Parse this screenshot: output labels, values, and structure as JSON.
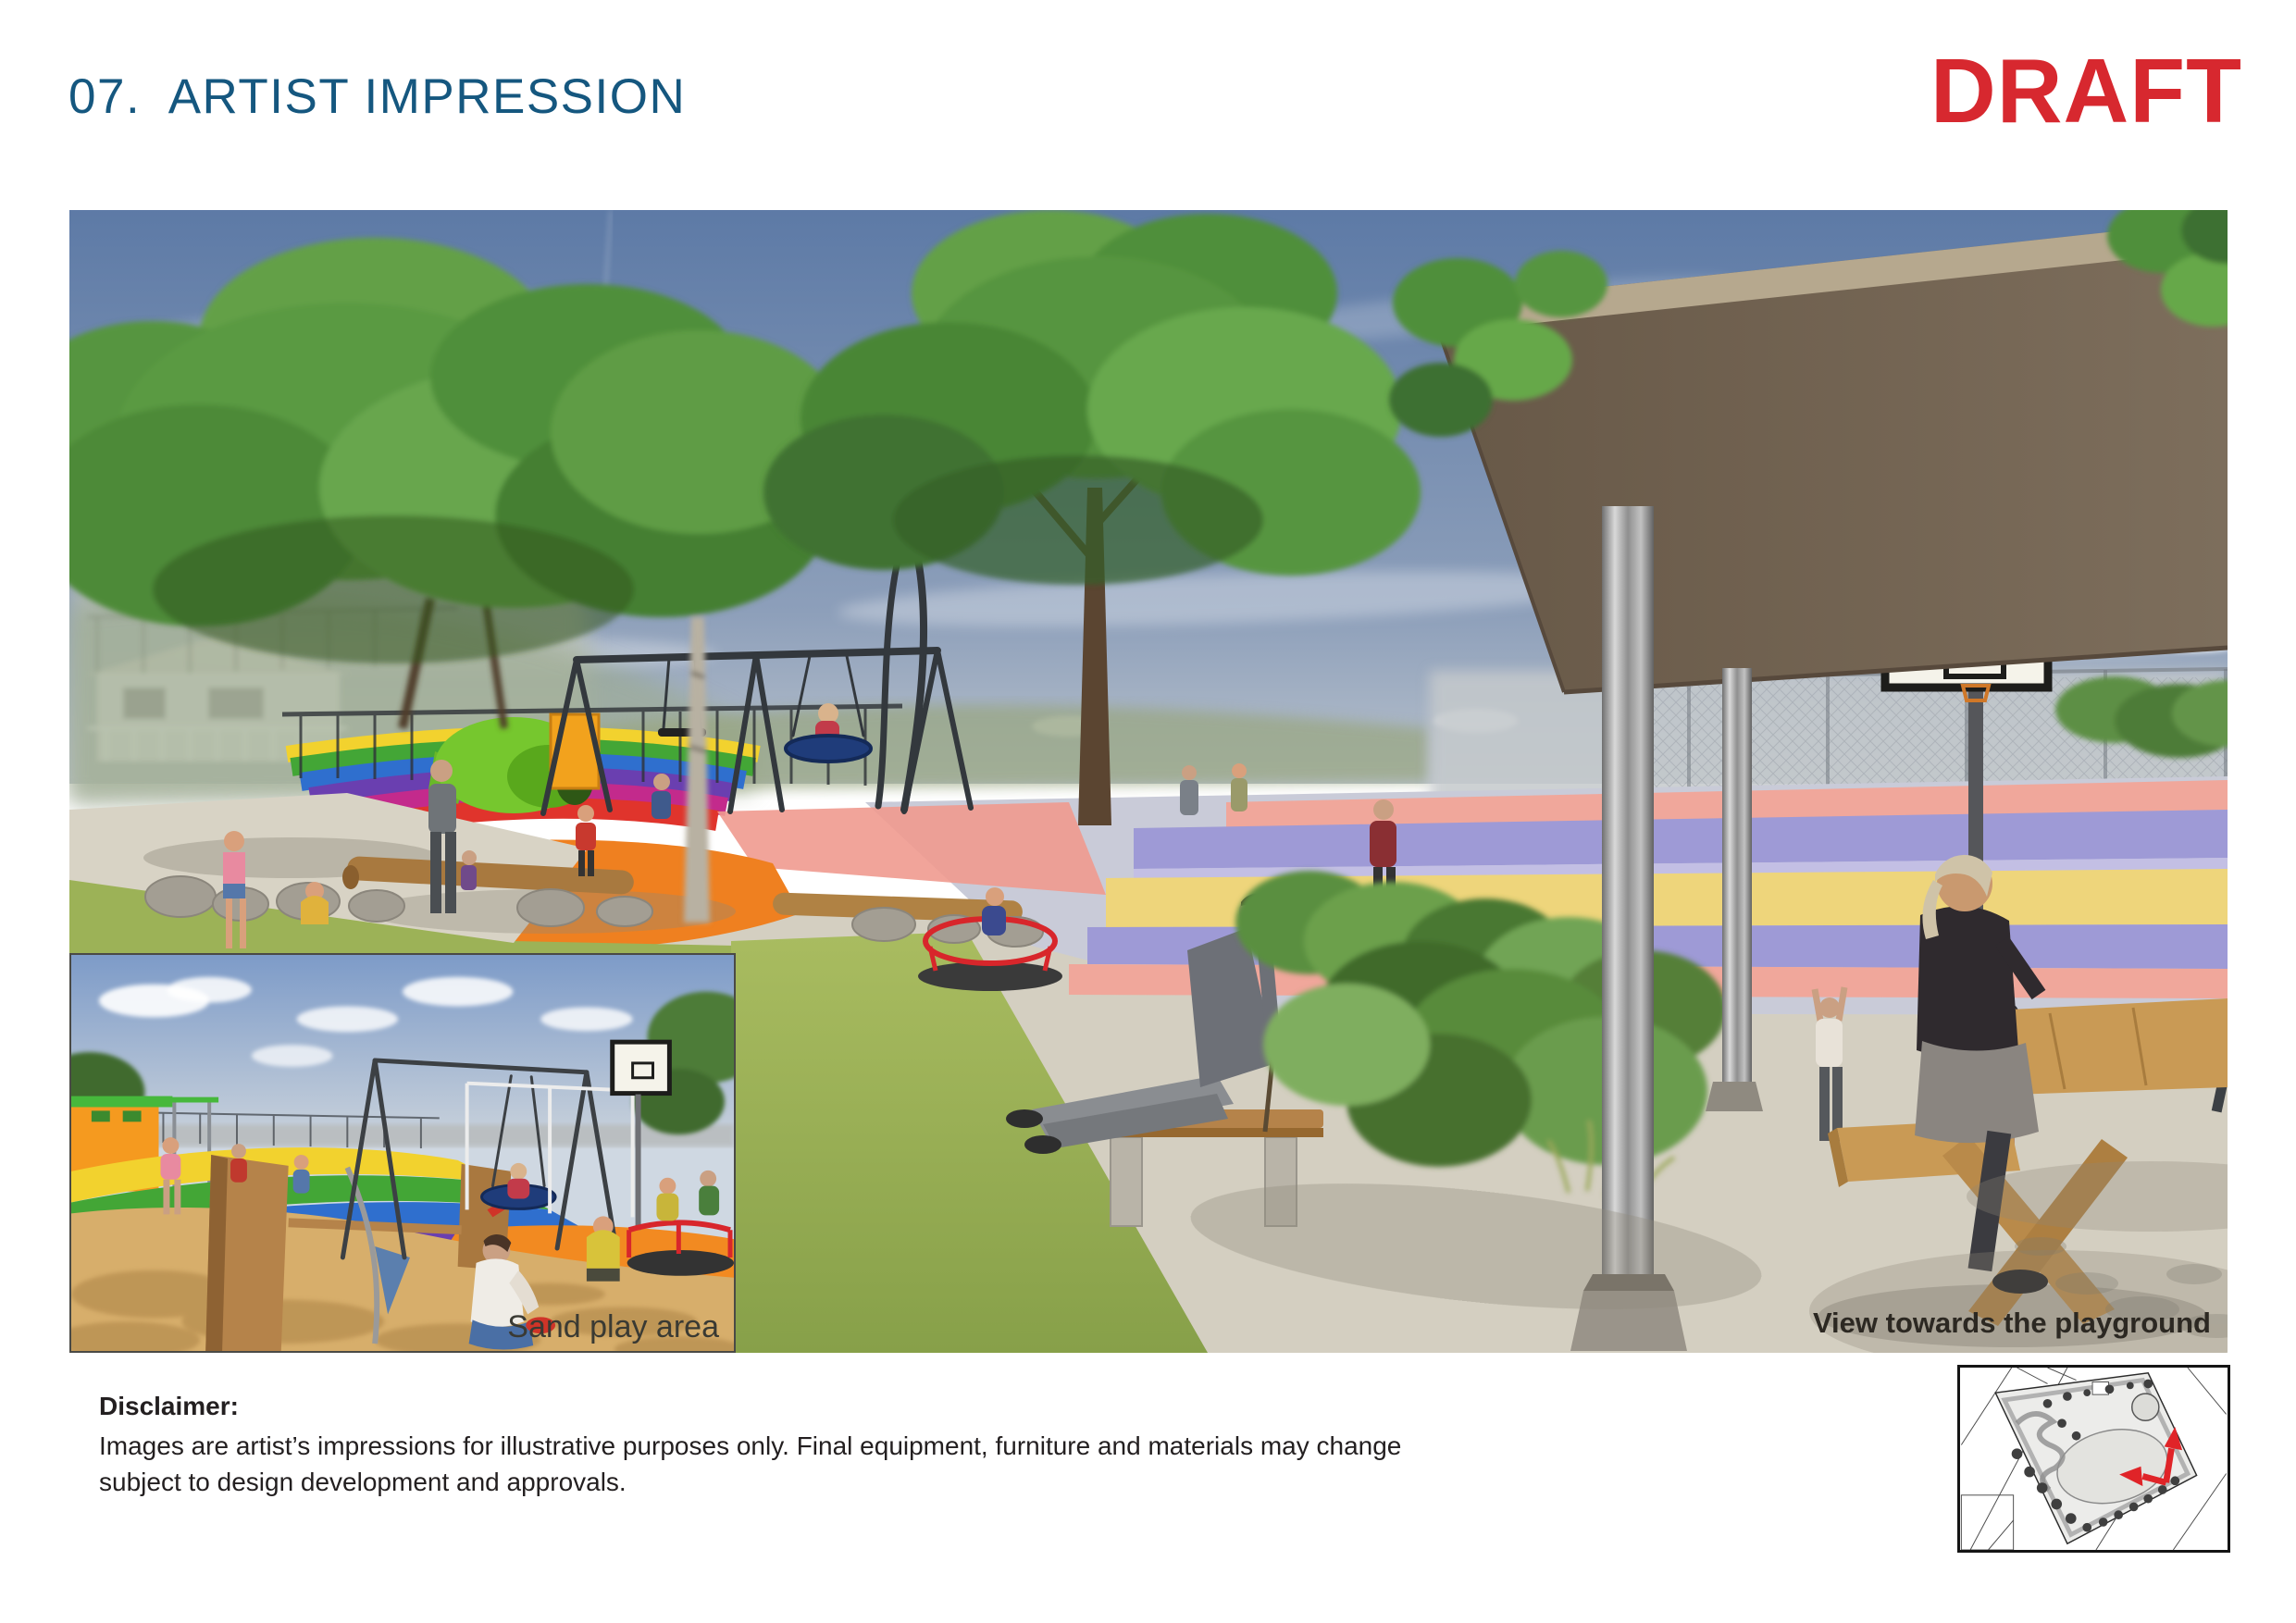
{
  "page": {
    "title": "07.  ARTIST IMPRESSION",
    "watermark": "DRAFT"
  },
  "main_image": {
    "caption": "View towards the playground"
  },
  "inset_image": {
    "caption": "Sand play area"
  },
  "disclaimer": {
    "heading": "Disclaimer:",
    "body": "Images are artist’s impressions for illustrative purposes only. Final equipment, furniture and materials may change subject to design development and approvals."
  },
  "colors": {
    "title_blue": "#15577f",
    "draft_red": "#d7282f",
    "body_text": "#231f20",
    "map_arrow_red": "#e02428",
    "canopy_brown": "#6e5f50",
    "court_yellow": "#eed57b",
    "court_purple": "#9e9ad6",
    "court_salmon": "#f0a79b"
  }
}
